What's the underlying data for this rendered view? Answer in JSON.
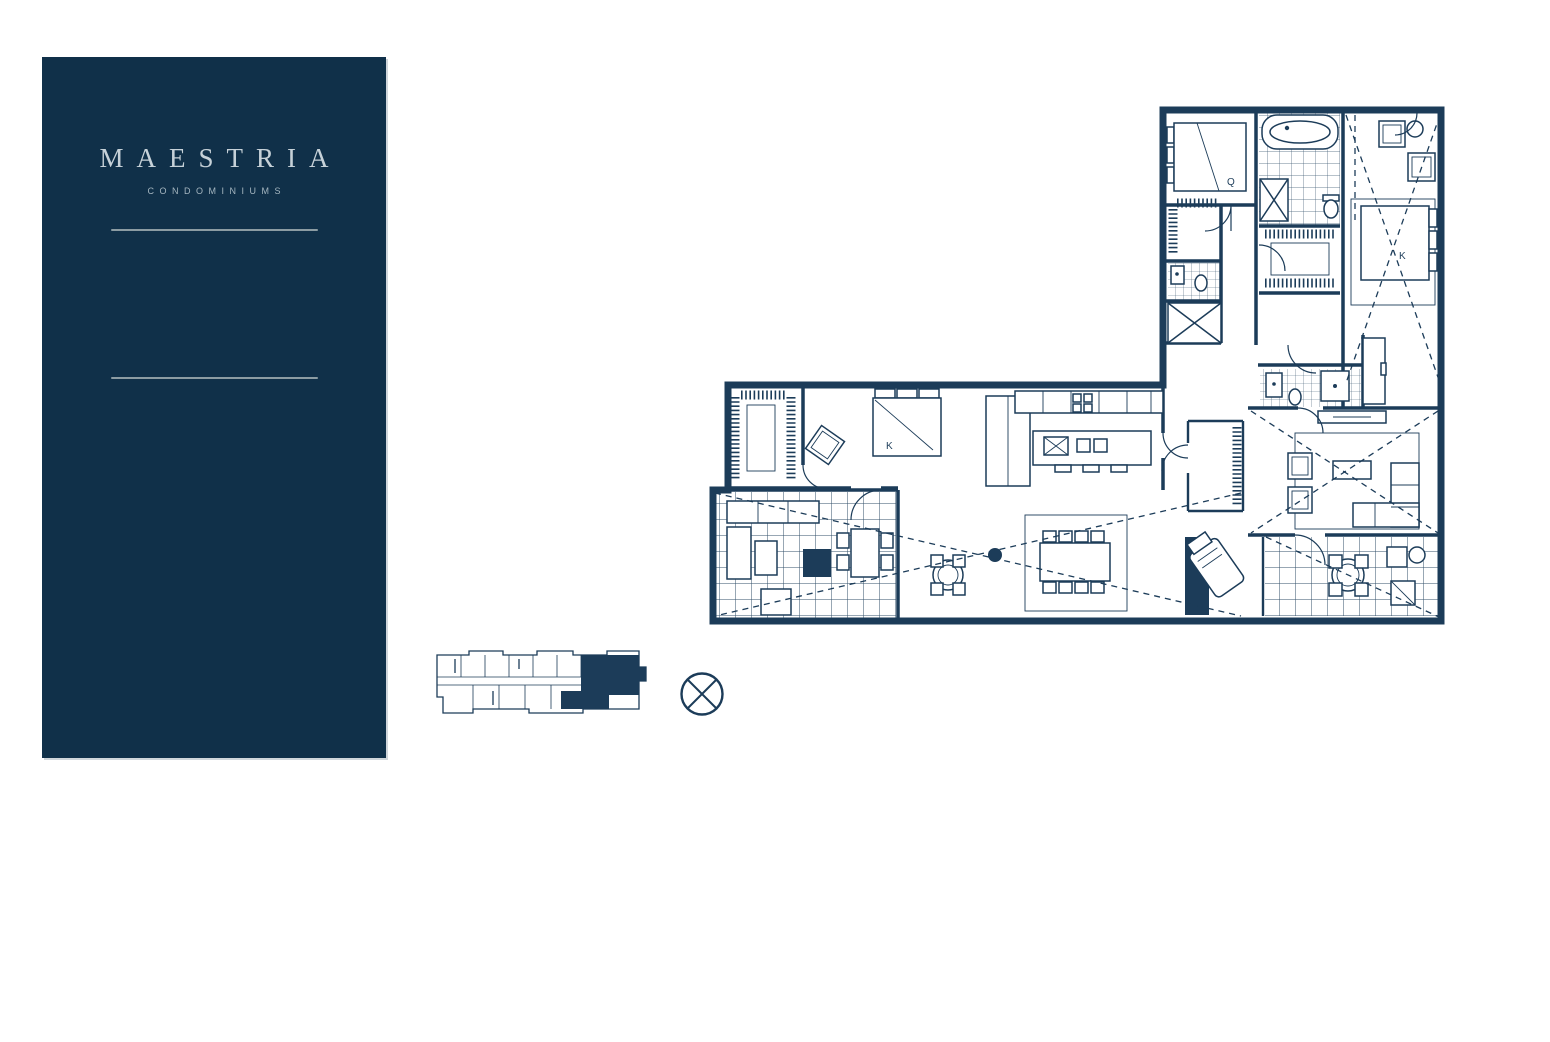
{
  "brand": {
    "title": "MAESTRIA",
    "subtitle": "CONDOMINIUMS"
  },
  "floor_plan": {
    "labels": {
      "bedroom_q": "Q",
      "bedroom_k_upper": "K",
      "bedroom_k_lower": "K"
    }
  },
  "colors": {
    "panel_navy": "#103049",
    "panel_text": "#C6D1D8",
    "panel_subtext": "#A5B6C0",
    "panel_rule": "#8C9CA3",
    "plan_ink": "#1C3C59",
    "background": "#FFFFFF"
  }
}
